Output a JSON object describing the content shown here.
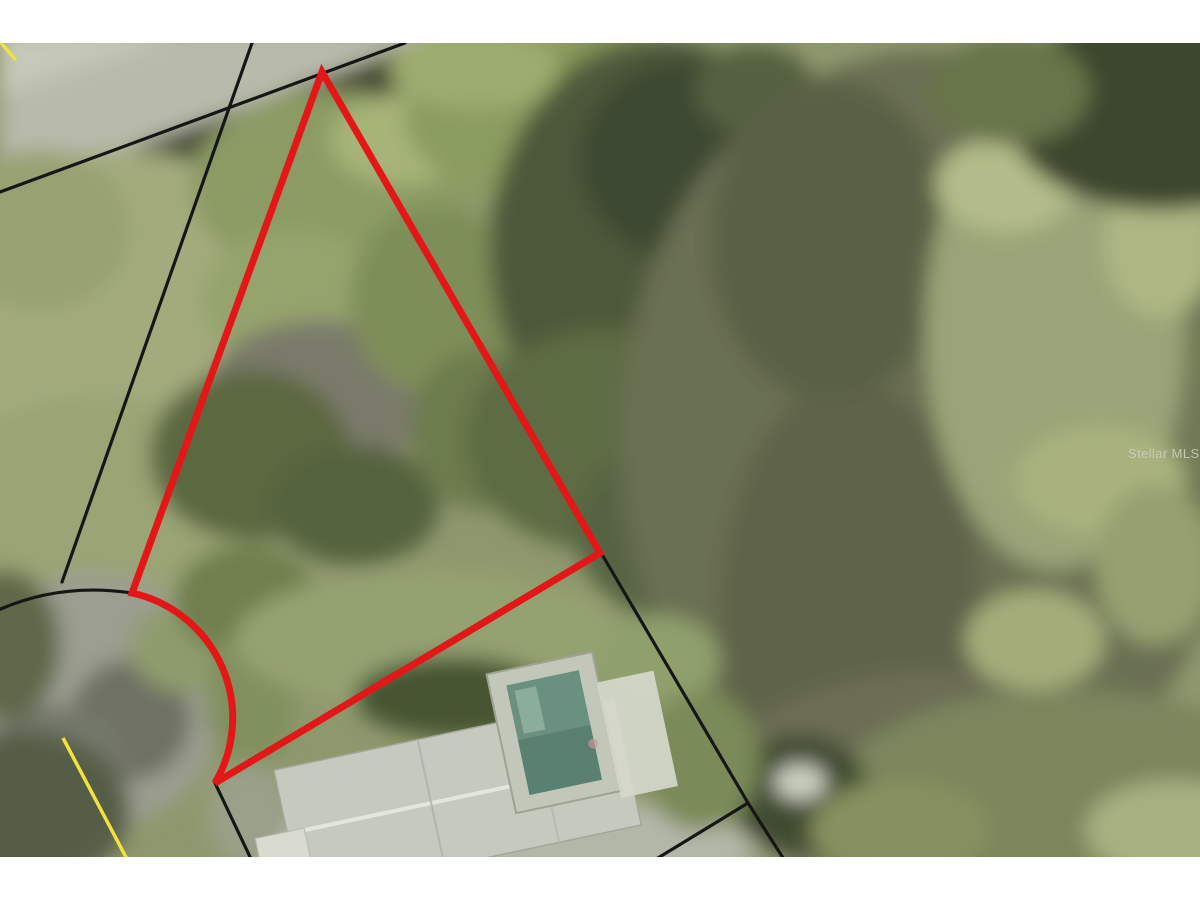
{
  "watermark": {
    "text": "Stellar MLS",
    "color": "#d2d4c4"
  },
  "boundary": {
    "color": "#e31717",
    "width": "7",
    "path": "M 322 72 L 600 553 L 215 783 A 128 128 0 0 0 132 593 Z"
  },
  "parcel_lines": {
    "color": "#161616",
    "width": "3.2",
    "road_edge": "M 405 43 L 0 192",
    "west_line": "M 252 43 L 62 582",
    "culdesac_arc": "M -6 612 Q 58 582 132 593",
    "south_boundary": "M 215 781 L 600 551",
    "east_underline": "M 322 74 L 598 553",
    "south_spur": "M 215 783 L 252 861",
    "east_line": "M 600 551 L 748 803",
    "branch_left": "M 748 803 L 653 861",
    "branch_right": "M 748 803 L 785 861"
  },
  "road_markings": {
    "color": "#f1e33c",
    "width": "3.5",
    "centerline_sw": "M 63 738 L 128 861",
    "corner_nw": "M -5 36 L 16 60"
  },
  "structures": {
    "roof_fill": "#c6c9be",
    "roof_edge": "#a3a79b",
    "roof_ridge": "#e8eae2",
    "roof_facet": "#aeb2a5",
    "shed_fill": "#d9dbd1",
    "pool_frame": "#c2c7b9",
    "pool_water": "#6a917f",
    "pool_water_deep": "#567d6d",
    "pool_highlight": "#93b4a4",
    "deck_fill": "#d5d8cb"
  }
}
